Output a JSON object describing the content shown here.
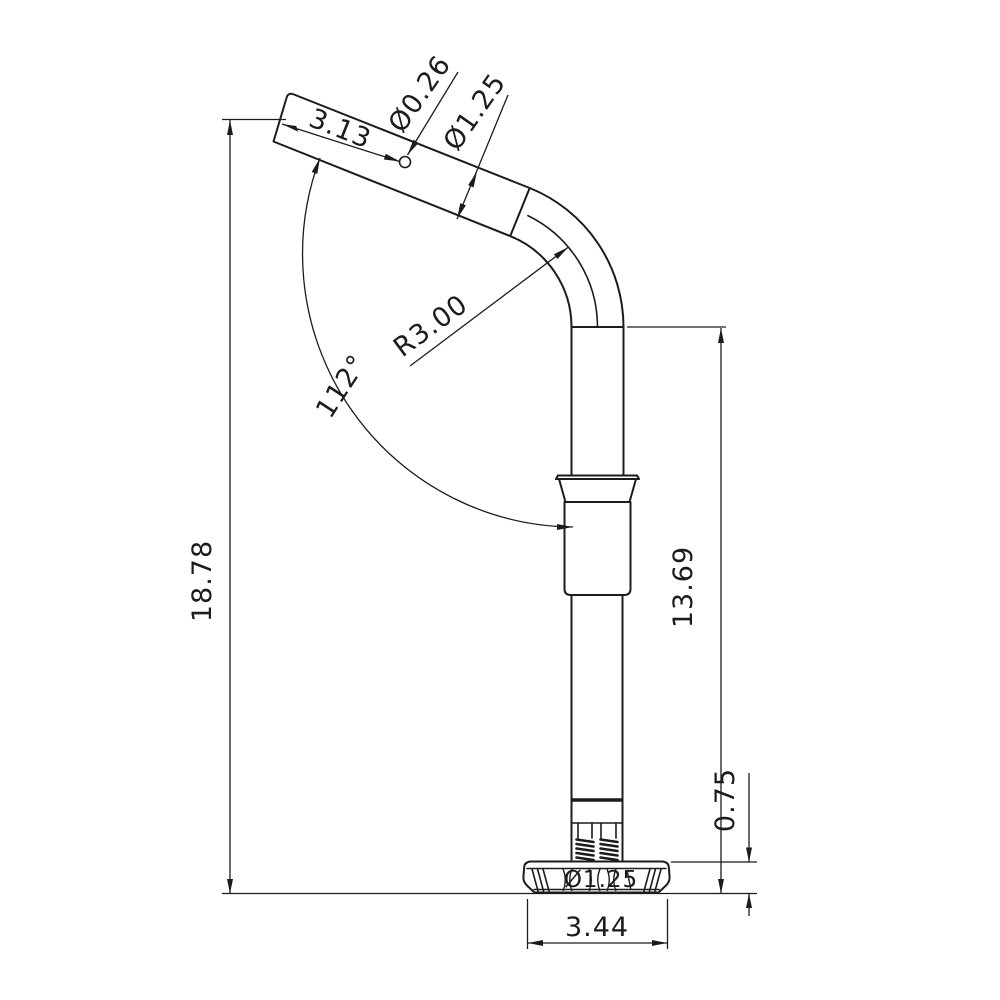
{
  "drawing": {
    "background": "#ffffff",
    "line_color": "#1c1c1c",
    "dimensions": {
      "end_section_length": "3.13",
      "hole_diameter": "Ø0.26",
      "tube_diameter": "Ø1.25",
      "bend_radius": "R3.00",
      "bend_angle": "112°",
      "overall_height": "18.78",
      "upright_height": "13.69",
      "base_height": "0.75",
      "base_bore_diameter": "Ø1.25",
      "base_width": "3.44"
    }
  }
}
